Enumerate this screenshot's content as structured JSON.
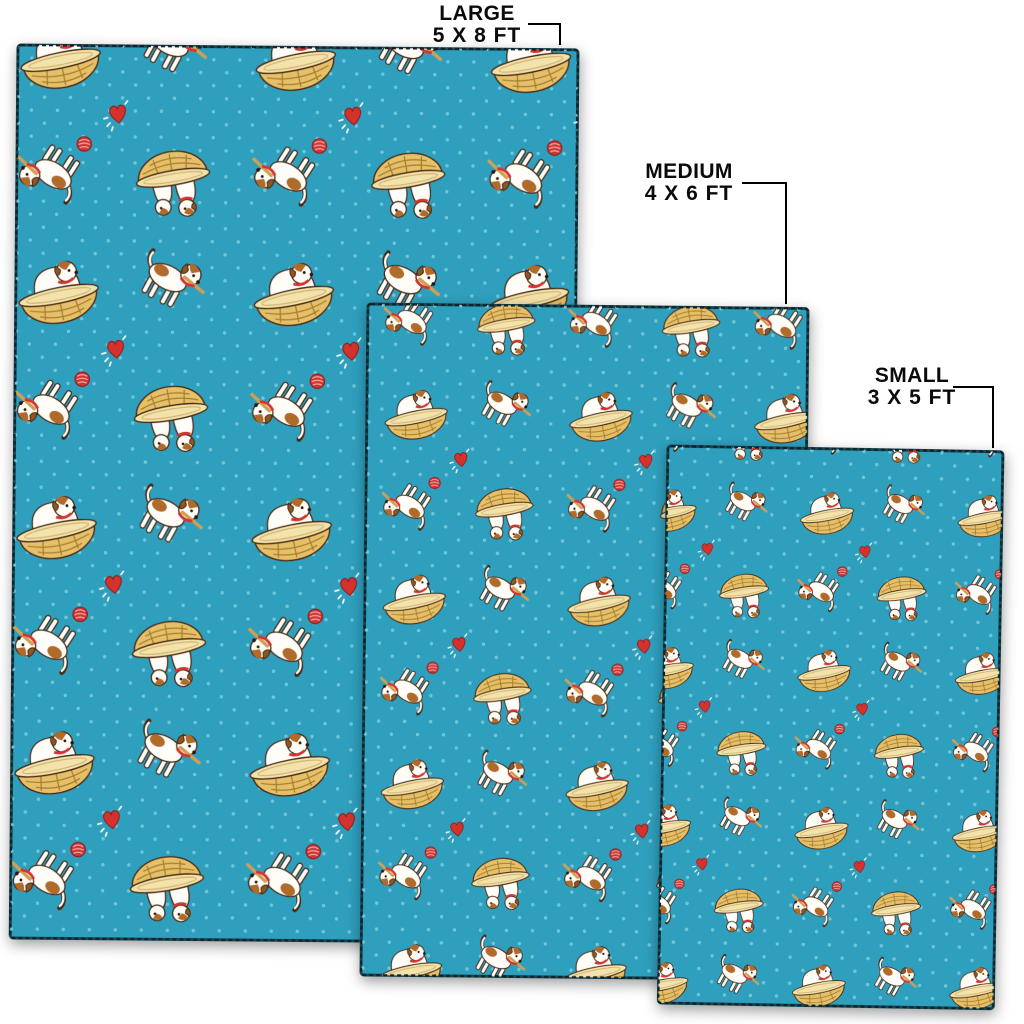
{
  "page": {
    "background": "#ffffff",
    "type": "rug-size-comparison-diagram"
  },
  "sizes": [
    {
      "id": "large",
      "name": "LARGE",
      "dims": "5 X 8 FT"
    },
    {
      "id": "medium",
      "name": "MEDIUM",
      "dims": "4 X 6 FT"
    },
    {
      "id": "small",
      "name": "SMALL",
      "dims": "3 X 5 FT"
    }
  ],
  "pattern": {
    "description": "Jack Russell terrier puppies playing with sticks and red yarn balls, puppies sitting in straw baskets, red hearts with white sparkles, on a teal background with light polka dots",
    "motifs": [
      "dog-in-basket",
      "two-dogs-in-basket",
      "standing-dog-with-stick",
      "rolling-dog-with-yarn-ball",
      "red-heart",
      "yarn-ball",
      "polka-dots"
    ],
    "colors": {
      "rug_background": "#2f9fbd",
      "polka_dot": "#6fc6d8",
      "edge_stitch": "#0e2b35",
      "dog_body": "#fffdf7",
      "dog_patch": "#b06a2c",
      "dog_outline": "#4a2a12",
      "collar": "#d43530",
      "basket": "#e5c069",
      "basket_rim": "#f3e2ab",
      "heart": "#d5312f",
      "yarn_ball": "#cf3433",
      "stick": "#cfa050",
      "label_text": "#0b0b0b",
      "leader_line": "#000000"
    }
  }
}
